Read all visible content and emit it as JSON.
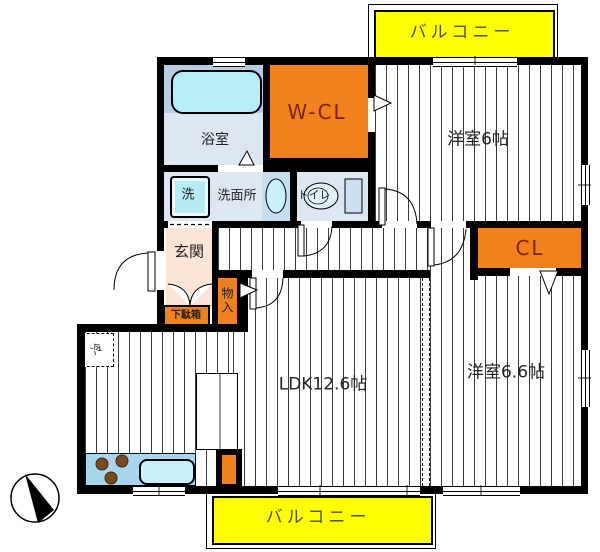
{
  "floorplan": {
    "labels": {
      "balcony_top": "バルコニー",
      "balcony_bottom": "バルコニー",
      "bathroom": "浴室",
      "washing_machine": "洗",
      "washroom": "洗面所",
      "toilet": "トイレ",
      "walk_in_closet": "W-CL",
      "bedroom_6": "洋室6帖",
      "closet": "CL",
      "entrance": "玄関",
      "storage": "物入",
      "shoe_cabinet": "下駄箱",
      "refrigerator": "冷",
      "ldk": "LDK12.6帖",
      "bedroom_66": "洋室6.6帖"
    },
    "colors": {
      "closet_orange": "#F0811C",
      "balcony_yellow": "#FFFF00",
      "wet_room_blue": "#DDE7F2",
      "bath_band_blue": "#B7CDE3",
      "tub_cyan": "#B5EEF6",
      "counter_blue": "#A9D6EF",
      "sink_cyan": "#C9F1FB",
      "entrance_peach": "#FBE5D6",
      "accent_text": "#7B2303",
      "burner_brown": "#7A4A1F",
      "wall_black": "#000000"
    }
  }
}
